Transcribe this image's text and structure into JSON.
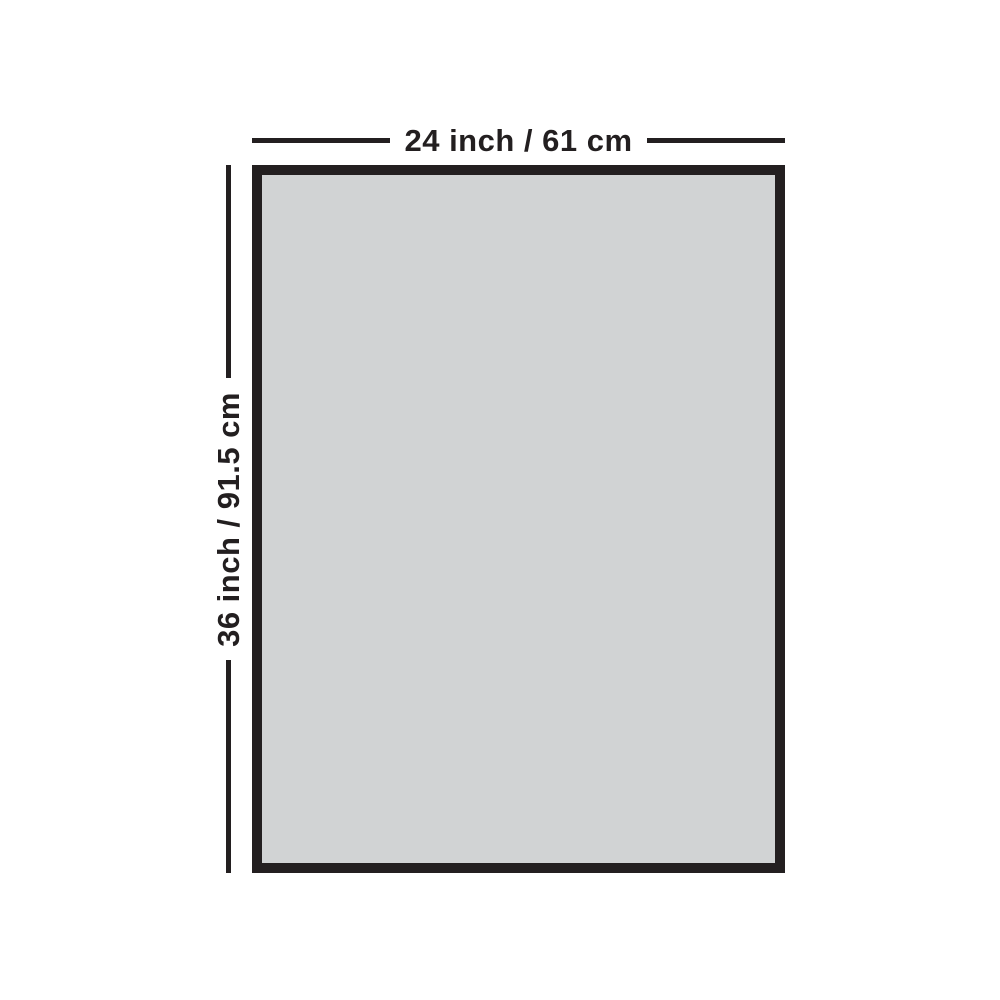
{
  "diagram": {
    "width_label": "24 inch / 61 cm",
    "height_label": "36 inch / 91.5 cm",
    "colors": {
      "outline": "#231f20",
      "fill": "#d1d3d4",
      "background": "#ffffff"
    }
  }
}
